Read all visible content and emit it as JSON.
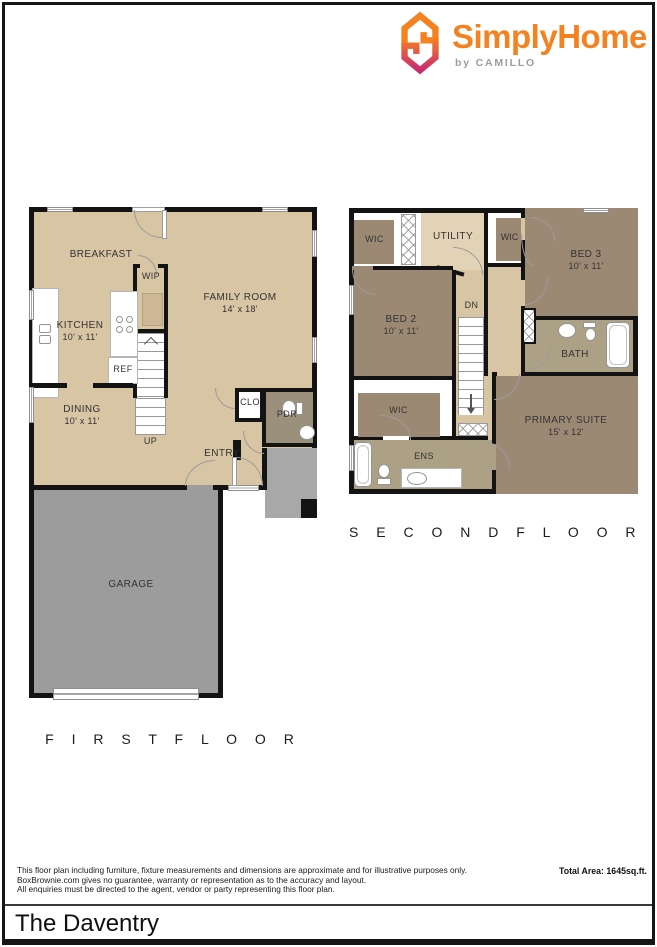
{
  "brand": {
    "name": "SimplyHome",
    "byline": "by CAMILLO",
    "colors": {
      "orange": "#F58220",
      "magenta": "#C92A72",
      "byline_gray": "#9B9EA0"
    }
  },
  "palette": {
    "floor_tan": "#D8C5A4",
    "floor_tan_light": "#E2D3B6",
    "floor_brown": "#9C8973",
    "floor_taupe": "#9A907B",
    "floor_bath": "#ACA184",
    "garage_gray": "#9C9C9C",
    "porch_gray": "#A8A8A8",
    "wall_black": "#131313"
  },
  "floors": {
    "first": {
      "label": "F I R S T   F L O O R",
      "rooms": {
        "breakfast": {
          "name": "BREAKFAST"
        },
        "kitchen": {
          "name": "KITCHEN",
          "dims": "10' x 11'"
        },
        "family_room": {
          "name": "FAMILY ROOM",
          "dims": "14' x 18'"
        },
        "dining": {
          "name": "DINING",
          "dims": "10' x 11'"
        },
        "wip": {
          "name": "WIP"
        },
        "ref": {
          "name": "REF"
        },
        "up": {
          "name": "UP"
        },
        "clo": {
          "name": "CLO"
        },
        "pdr": {
          "name": "PDR"
        },
        "entry": {
          "name": "ENTRY"
        },
        "garage": {
          "name": "GARAGE"
        }
      }
    },
    "second": {
      "label": "S E C O N D   F L O O R",
      "rooms": {
        "wic1": {
          "name": "WIC"
        },
        "utility": {
          "name": "UTILITY"
        },
        "wic2": {
          "name": "WIC"
        },
        "bed3": {
          "name": "BED 3",
          "dims": "10' x 11'"
        },
        "bed2": {
          "name": "BED 2",
          "dims": "10' x 11'"
        },
        "dn": {
          "name": "DN"
        },
        "bath": {
          "name": "BATH"
        },
        "wic3": {
          "name": "WIC"
        },
        "ens": {
          "name": "ENS"
        },
        "primary": {
          "name": "PRIMARY SUITE",
          "dims": "15' x 12'"
        }
      }
    }
  },
  "footer": {
    "disclaimer_lines": [
      "This floor plan including furniture, fixture measurements and dimensions are approximate and for illustrative purposes only.",
      "BoxBrownie.com gives no guarantee, warranty or representation as to the accuracy and layout.",
      "All enquiries must be directed to the agent, vendor or party representing this floor plan."
    ],
    "total_area": "Total Area: 1645sq.ft.",
    "plan_name": "The Daventry"
  }
}
